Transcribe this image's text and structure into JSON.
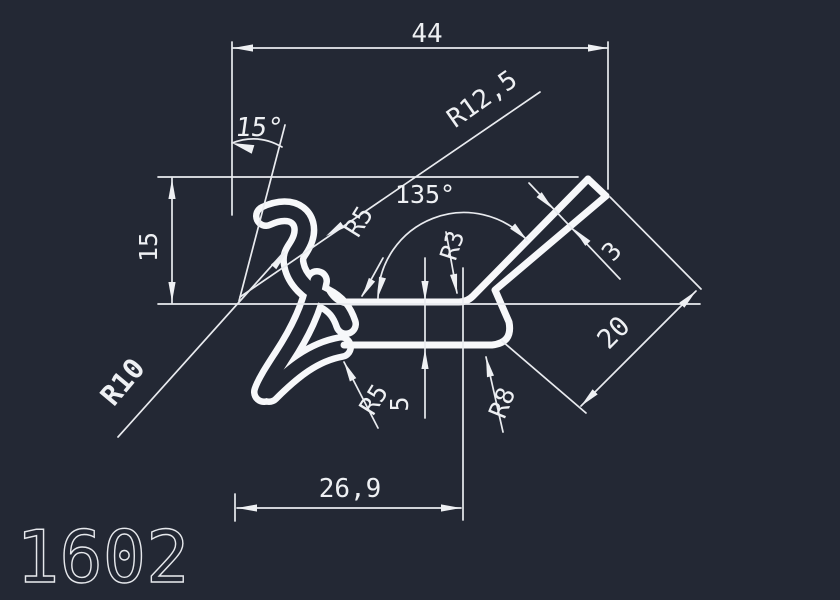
{
  "drawing": {
    "background_color": "#232834",
    "line_color": "#eef0f3",
    "part_number": "1602",
    "dimensions": {
      "overall_width": "44",
      "lip_angle": "15°",
      "left_height": "15",
      "lip_outer_radius": "R12,5",
      "neck_radius": "R5",
      "arm_angle": "135°",
      "arm_root_radius": "R3",
      "arm_thickness": "3",
      "arm_length": "20",
      "hook_radius": "R10",
      "foot_radius": "R5",
      "base_thickness": "5",
      "step_radius": "R8",
      "base_width": "26,9"
    }
  }
}
